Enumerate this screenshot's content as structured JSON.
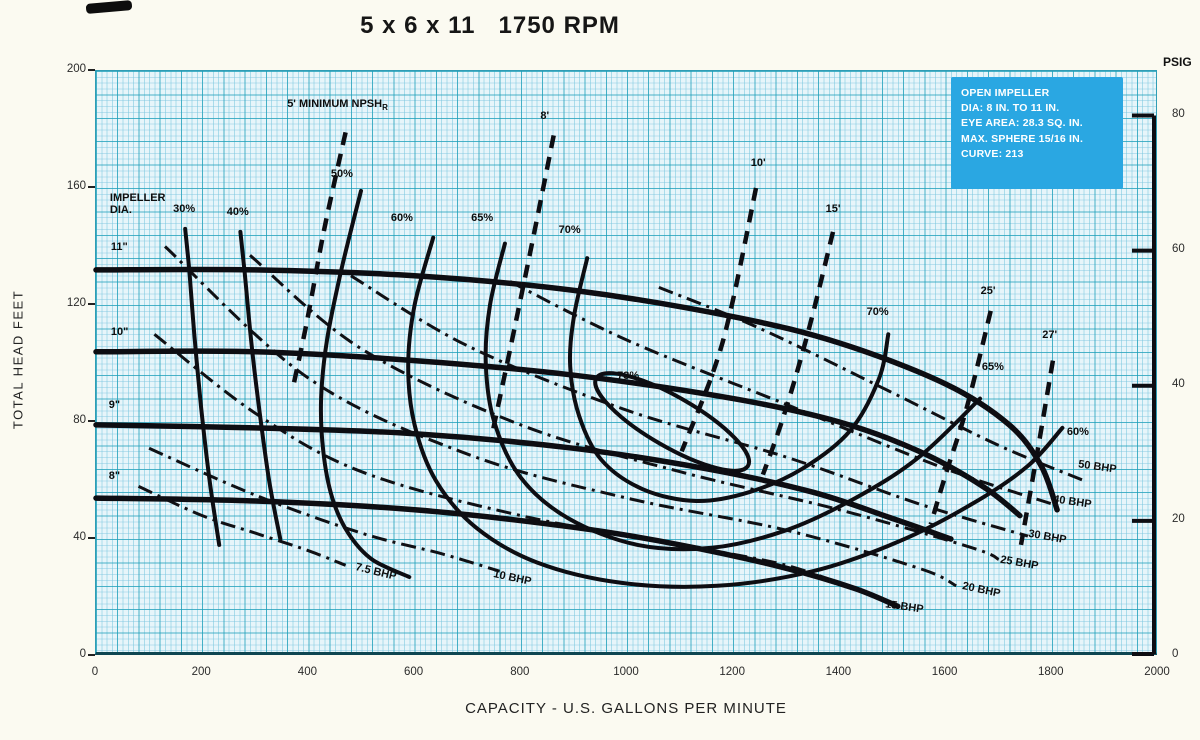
{
  "chart_data": {
    "type": "line",
    "title": "5 x 6 x 11   1750 RPM",
    "x_axis": {
      "label": "CAPACITY - U.S. GALLONS PER MINUTE",
      "min": 0,
      "max": 2000,
      "ticks": [
        0,
        200,
        400,
        600,
        800,
        1000,
        1200,
        1400,
        1600,
        1800,
        2000
      ]
    },
    "y_axis_left": {
      "label": "TOTAL HEAD FEET",
      "min": 0,
      "max": 200,
      "ticks": [
        0,
        40,
        80,
        120,
        160,
        200
      ]
    },
    "y_axis_right": {
      "label": "PSIG",
      "min": 0,
      "max": 80,
      "ticks": [
        0,
        20,
        40,
        60,
        80
      ],
      "ft_per_psi": 2.31
    },
    "grid": true,
    "info_box": {
      "bg_color": "#2aa7e2",
      "text_color": "#ffffff",
      "lines": [
        "OPEN IMPELLER",
        "DIA: 8 IN. TO 11 IN.",
        "EYE AREA: 28.3 SQ. IN.",
        "MAX. SPHERE 15/16 IN.",
        "CURVE: 213"
      ]
    },
    "impeller_section_label": {
      "text": "IMPELLER\nDIA.",
      "x": 28,
      "y": 156,
      "anchor": "start"
    },
    "impeller_curves": [
      {
        "name": "11\"",
        "label": {
          "text": "11\"",
          "x": 30,
          "y": 139,
          "anchor": "start"
        },
        "points": [
          [
            0,
            132
          ],
          [
            300,
            132
          ],
          [
            600,
            130
          ],
          [
            900,
            125
          ],
          [
            1200,
            116
          ],
          [
            1400,
            107
          ],
          [
            1600,
            93
          ],
          [
            1720,
            79
          ],
          [
            1780,
            65
          ],
          [
            1810,
            50
          ]
        ]
      },
      {
        "name": "10\"",
        "label": {
          "text": "10\"",
          "x": 30,
          "y": 110,
          "anchor": "start"
        },
        "points": [
          [
            0,
            104
          ],
          [
            300,
            104
          ],
          [
            600,
            101
          ],
          [
            900,
            96
          ],
          [
            1200,
            88
          ],
          [
            1400,
            80
          ],
          [
            1550,
            70
          ],
          [
            1670,
            58
          ],
          [
            1740,
            48
          ]
        ]
      },
      {
        "name": "9\"",
        "label": {
          "text": "9\"",
          "x": 26,
          "y": 85,
          "anchor": "start"
        },
        "points": [
          [
            0,
            79
          ],
          [
            300,
            78
          ],
          [
            600,
            76
          ],
          [
            900,
            71
          ],
          [
            1150,
            64
          ],
          [
            1350,
            56
          ],
          [
            1500,
            47
          ],
          [
            1610,
            40
          ]
        ]
      },
      {
        "name": "8\"",
        "label": {
          "text": "8\"",
          "x": 26,
          "y": 61,
          "anchor": "start"
        },
        "points": [
          [
            0,
            54
          ],
          [
            300,
            53
          ],
          [
            600,
            50
          ],
          [
            900,
            44
          ],
          [
            1100,
            38
          ],
          [
            1300,
            30
          ],
          [
            1430,
            23
          ],
          [
            1510,
            17
          ]
        ]
      }
    ],
    "efficiency_curves": [
      {
        "value": "30%",
        "labels": [
          {
            "text": "30%",
            "x": 168,
            "y": 152
          }
        ],
        "points": [
          [
            168,
            146
          ],
          [
            176,
            131
          ],
          [
            186,
            108
          ],
          [
            198,
            85
          ],
          [
            214,
            60
          ],
          [
            232,
            38
          ]
        ]
      },
      {
        "value": "40%",
        "labels": [
          {
            "text": "40%",
            "x": 269,
            "y": 151
          }
        ],
        "points": [
          [
            272,
            145
          ],
          [
            280,
            131
          ],
          [
            292,
            108
          ],
          [
            307,
            85
          ],
          [
            326,
            60
          ],
          [
            347,
            40
          ]
        ]
      },
      {
        "value": "50%",
        "labels": [
          {
            "text": "50%",
            "x": 465,
            "y": 164
          }
        ],
        "points": [
          [
            499,
            159
          ],
          [
            462,
            132
          ],
          [
            435,
            108
          ],
          [
            424,
            88
          ],
          [
            428,
            70
          ],
          [
            445,
            54
          ],
          [
            475,
            42
          ],
          [
            520,
            33
          ],
          [
            590,
            27
          ]
        ]
      },
      {
        "value": "60%",
        "labels": [
          {
            "text": "60%",
            "x": 578,
            "y": 149
          },
          {
            "text": "60%",
            "x": 1851,
            "y": 76
          }
        ],
        "points": [
          [
            635,
            143
          ],
          [
            600,
            120
          ],
          [
            588,
            99
          ],
          [
            600,
            79
          ],
          [
            640,
            60
          ],
          [
            715,
            44
          ],
          [
            830,
            32
          ],
          [
            990,
            25
          ],
          [
            1170,
            24
          ],
          [
            1350,
            29
          ],
          [
            1510,
            39
          ],
          [
            1650,
            52
          ],
          [
            1755,
            65
          ],
          [
            1820,
            78
          ]
        ]
      },
      {
        "value": "65%",
        "labels": [
          {
            "text": "65%",
            "x": 729,
            "y": 149
          },
          {
            "text": "65%",
            "x": 1691,
            "y": 98
          }
        ],
        "points": [
          [
            770,
            141
          ],
          [
            742,
            120
          ],
          [
            734,
            100
          ],
          [
            750,
            80
          ],
          [
            800,
            61
          ],
          [
            890,
            47
          ],
          [
            1020,
            38
          ],
          [
            1160,
            37
          ],
          [
            1300,
            43
          ],
          [
            1430,
            54
          ],
          [
            1550,
            68
          ],
          [
            1665,
            88
          ]
        ]
      },
      {
        "value": "70%",
        "labels": [
          {
            "text": "70%",
            "x": 894,
            "y": 145
          },
          {
            "text": "70%",
            "x": 1474,
            "y": 117
          }
        ],
        "points": [
          [
            925,
            136
          ],
          [
            900,
            116
          ],
          [
            893,
            99
          ],
          [
            910,
            82
          ],
          [
            952,
            67
          ],
          [
            1030,
            57
          ],
          [
            1130,
            53
          ],
          [
            1230,
            56
          ],
          [
            1330,
            64
          ],
          [
            1420,
            77
          ],
          [
            1475,
            95
          ],
          [
            1492,
            110
          ]
        ]
      }
    ],
    "bep_ellipse": {
      "value": "73%",
      "label": {
        "text": "73%",
        "x": 1004,
        "y": 95
      },
      "center": [
        1085,
        80
      ],
      "rx_gpm": 165,
      "ry_ft": 8.5,
      "rotate_deg": 30
    },
    "npsh_lines": [
      {
        "value": "5 ft",
        "label": {
          "text": "5' MINIMUM NPSH",
          "sub": "R",
          "x": 362,
          "y": 188,
          "anchor": "start"
        },
        "points": [
          [
            470,
            179
          ],
          [
            430,
            146
          ],
          [
            398,
            115
          ],
          [
            370,
            91
          ]
        ]
      },
      {
        "value": "8 ft",
        "label": {
          "text": "8'",
          "x": 847,
          "y": 184
        },
        "points": [
          [
            862,
            178
          ],
          [
            820,
            140
          ],
          [
            780,
            105
          ],
          [
            745,
            75
          ]
        ]
      },
      {
        "value": "10 ft",
        "label": {
          "text": "10'",
          "x": 1249,
          "y": 168
        },
        "points": [
          [
            1243,
            160
          ],
          [
            1195,
            118
          ],
          [
            1160,
            96
          ],
          [
            1103,
            70
          ]
        ]
      },
      {
        "value": "15 ft",
        "label": {
          "text": "15'",
          "x": 1390,
          "y": 152
        },
        "points": [
          [
            1388,
            145
          ],
          [
            1340,
            110
          ],
          [
            1295,
            82
          ],
          [
            1256,
            62
          ]
        ]
      },
      {
        "value": "25 ft",
        "label": {
          "text": "25'",
          "x": 1682,
          "y": 124
        },
        "points": [
          [
            1685,
            118
          ],
          [
            1640,
            85
          ],
          [
            1600,
            62
          ],
          [
            1572,
            45
          ]
        ]
      },
      {
        "value": "27 ft",
        "label": {
          "text": "27'",
          "x": 1798,
          "y": 109
        },
        "points": [
          [
            1802,
            101
          ],
          [
            1775,
            72
          ],
          [
            1742,
            38
          ]
        ]
      }
    ],
    "bhp_lines": [
      {
        "value": "7.5 BHP",
        "label": {
          "text": "7.5 BHP",
          "x": 490,
          "y": 28,
          "rot": 14,
          "anchor": "start"
        },
        "points": [
          [
            80,
            58
          ],
          [
            200,
            48
          ],
          [
            300,
            42
          ],
          [
            400,
            36
          ],
          [
            470,
            31
          ]
        ]
      },
      {
        "value": "10 BHP",
        "label": {
          "text": "10 BHP",
          "x": 750,
          "y": 26,
          "rot": 12,
          "anchor": "start"
        },
        "points": [
          [
            100,
            71
          ],
          [
            300,
            55
          ],
          [
            500,
            42
          ],
          [
            650,
            35
          ],
          [
            760,
            29
          ]
        ]
      },
      {
        "value": "15 BHP",
        "label": {
          "text": "15 BHP",
          "x": 1488,
          "y": 16,
          "rot": 8,
          "anchor": "start"
        },
        "points": [
          [
            110,
            110
          ],
          [
            300,
            83
          ],
          [
            500,
            63
          ],
          [
            800,
            48
          ],
          [
            1100,
            38
          ],
          [
            1300,
            31
          ],
          [
            1440,
            22
          ]
        ]
      },
      {
        "value": "20 BHP",
        "label": {
          "text": "20 BHP",
          "x": 1633,
          "y": 22,
          "rot": 12,
          "anchor": "start"
        },
        "points": [
          [
            130,
            140
          ],
          [
            400,
            95
          ],
          [
            700,
            69
          ],
          [
            1000,
            54
          ],
          [
            1300,
            43
          ],
          [
            1550,
            30
          ],
          [
            1620,
            24
          ]
        ]
      },
      {
        "value": "25 BHP",
        "label": {
          "text": "25 BHP",
          "x": 1704,
          "y": 31,
          "rot": 10,
          "anchor": "start"
        },
        "points": [
          [
            290,
            137
          ],
          [
            500,
            105
          ],
          [
            800,
            79
          ],
          [
            1100,
            63
          ],
          [
            1400,
            50
          ],
          [
            1650,
            37
          ],
          [
            1700,
            33
          ]
        ]
      },
      {
        "value": "30 BHP",
        "label": {
          "text": "30 BHP",
          "x": 1757,
          "y": 40,
          "rot": 10,
          "anchor": "start"
        },
        "points": [
          [
            480,
            130
          ],
          [
            700,
            106
          ],
          [
            1000,
            84
          ],
          [
            1300,
            68
          ],
          [
            1550,
            52
          ],
          [
            1755,
            41
          ]
        ]
      },
      {
        "value": "40 BHP",
        "label": {
          "text": "40 BHP",
          "x": 1804,
          "y": 52,
          "rot": 8,
          "anchor": "start"
        },
        "points": [
          [
            780,
            128
          ],
          [
            1000,
            108
          ],
          [
            1300,
            86
          ],
          [
            1600,
            64
          ],
          [
            1800,
            52
          ]
        ]
      },
      {
        "value": "50 BHP",
        "label": {
          "text": "50 BHP",
          "x": 1851,
          "y": 64,
          "rot": 8,
          "anchor": "start"
        },
        "points": [
          [
            1060,
            126
          ],
          [
            1250,
            112
          ],
          [
            1500,
            90
          ],
          [
            1700,
            72
          ],
          [
            1860,
            60
          ]
        ]
      }
    ],
    "colors": {
      "curve": "#0d0d12",
      "grid_major": "#1a9eb7",
      "grid_minor": "#8fcfe2",
      "plot_bg": "#e7f5fa",
      "info_box_bg": "#2aa7e2"
    }
  }
}
